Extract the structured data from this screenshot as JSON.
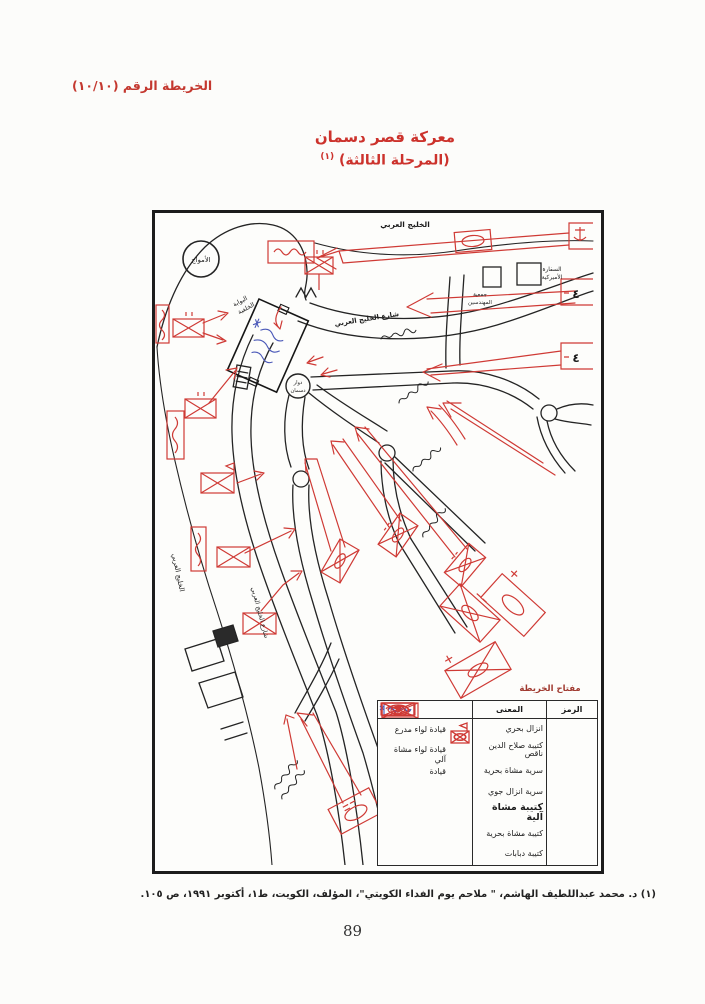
{
  "page": {
    "header_label": "الخريطة الرقم (١٠/١٠)",
    "title_line1": "معركة قصر دسمان",
    "title_line2": "(المرحلة الثالثة)",
    "title_footnote_mark": "(١)",
    "footnote": "(١) د. محمد عبداللطيف الهاشم، \" ملاحم يوم الفداء الكويتي\"، المؤلف، الكويت، ط١، أكتوبر ١٩٩١، ص ١٠٥.",
    "page_number": "89"
  },
  "map": {
    "labels": {
      "gulf_top": "الخليج العربي",
      "gulf_left": "الخليج العربي",
      "gulf_street_top": "شارع الخليج العربي",
      "gulf_street_left": "شارع الخليج العربي",
      "amwaj": "الأمواج",
      "us_embassy_l1": "السفارة",
      "us_embassy_l2": "الأميركية",
      "engineers_l1": "جمعية",
      "engineers_l2": "المهندسين",
      "rear_gate_l1": "البوابة",
      "rear_gate_l2": "الخلفية",
      "dasman_l1": "دوار",
      "dasman_l2": "دسمان",
      "brigade_4_a": "٤",
      "brigade_4_b": "٤"
    },
    "colors": {
      "ink": "#1c1c1c",
      "red": "#cf3a35",
      "blue": "#4a58b8"
    }
  },
  "legend": {
    "title": "مفتاح الخريطة",
    "col_symbol": "الرمز",
    "col_meaning": "المعنى",
    "rows": [
      {
        "meaning": "انزال بحري"
      },
      {
        "meaning": "كتيبة صلاح الدين ناقص"
      },
      {
        "meaning": "سرية مشاة بحرية"
      },
      {
        "meaning": "سرية انزال جوي"
      },
      {
        "meaning": "كتيبة مشاة آلية"
      },
      {
        "meaning": "كتيبة مشاة بحرية"
      },
      {
        "meaning": "كتيبة دبابات"
      }
    ],
    "commands": [
      {
        "label": "قيادة لواء مدرع"
      },
      {
        "label": "قيادة لواء مشاة آلي"
      },
      {
        "label": "قيادة"
      }
    ]
  }
}
